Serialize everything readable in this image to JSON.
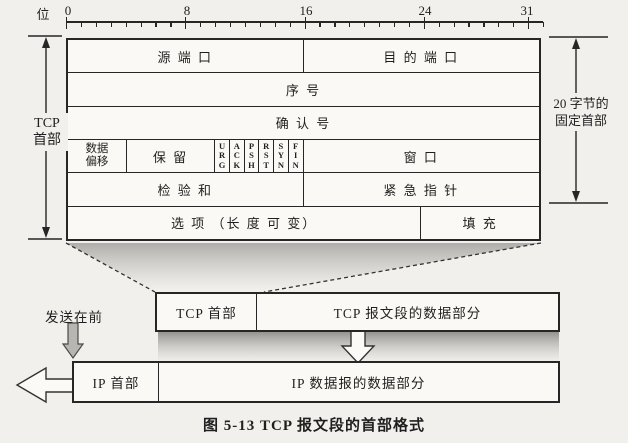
{
  "colors": {
    "paper": "#f1f0ec",
    "cell": "#faf9f5",
    "line": "#262626",
    "ink": "#1f1f1f"
  },
  "ruler": {
    "unit": "位",
    "bit_count": 32,
    "major_bits": [
      0,
      8,
      16,
      24,
      31
    ],
    "labels": [
      {
        "text": "0",
        "x": 68
      },
      {
        "text": "8",
        "x": 187
      },
      {
        "text": "16",
        "x": 306
      },
      {
        "text": "24",
        "x": 425
      },
      {
        "text": "31",
        "x": 527
      }
    ]
  },
  "header_table": {
    "source_port": "源 端 口",
    "dest_port": "目 的 端 口",
    "seq_no": "序  号",
    "ack_no": "确  认  号",
    "data_offset_l1": "数据",
    "data_offset_l2": "偏移",
    "reserved": "保  留",
    "flags": [
      "URG",
      "ACK",
      "PSH",
      "RST",
      "SYN",
      "FIN"
    ],
    "window": "窗  口",
    "checksum": "检 验 和",
    "urgent_pointer": "紧 急 指 针",
    "options": "选 项 （长 度 可 变）",
    "padding": "填  充"
  },
  "left_measure": {
    "line1": "TCP",
    "line2": "首部"
  },
  "right_measure": {
    "line1": "20 字节的",
    "line2": "固定首部"
  },
  "tcp_bar": {
    "header": "TCP 首部",
    "data": "TCP 报文段的数据部分"
  },
  "ip_bar": {
    "header": "IP 首部",
    "data": "IP 数据报的数据部分"
  },
  "send_first": "发送在前",
  "caption": "图 5-13   TCP 报文段的首部格式"
}
